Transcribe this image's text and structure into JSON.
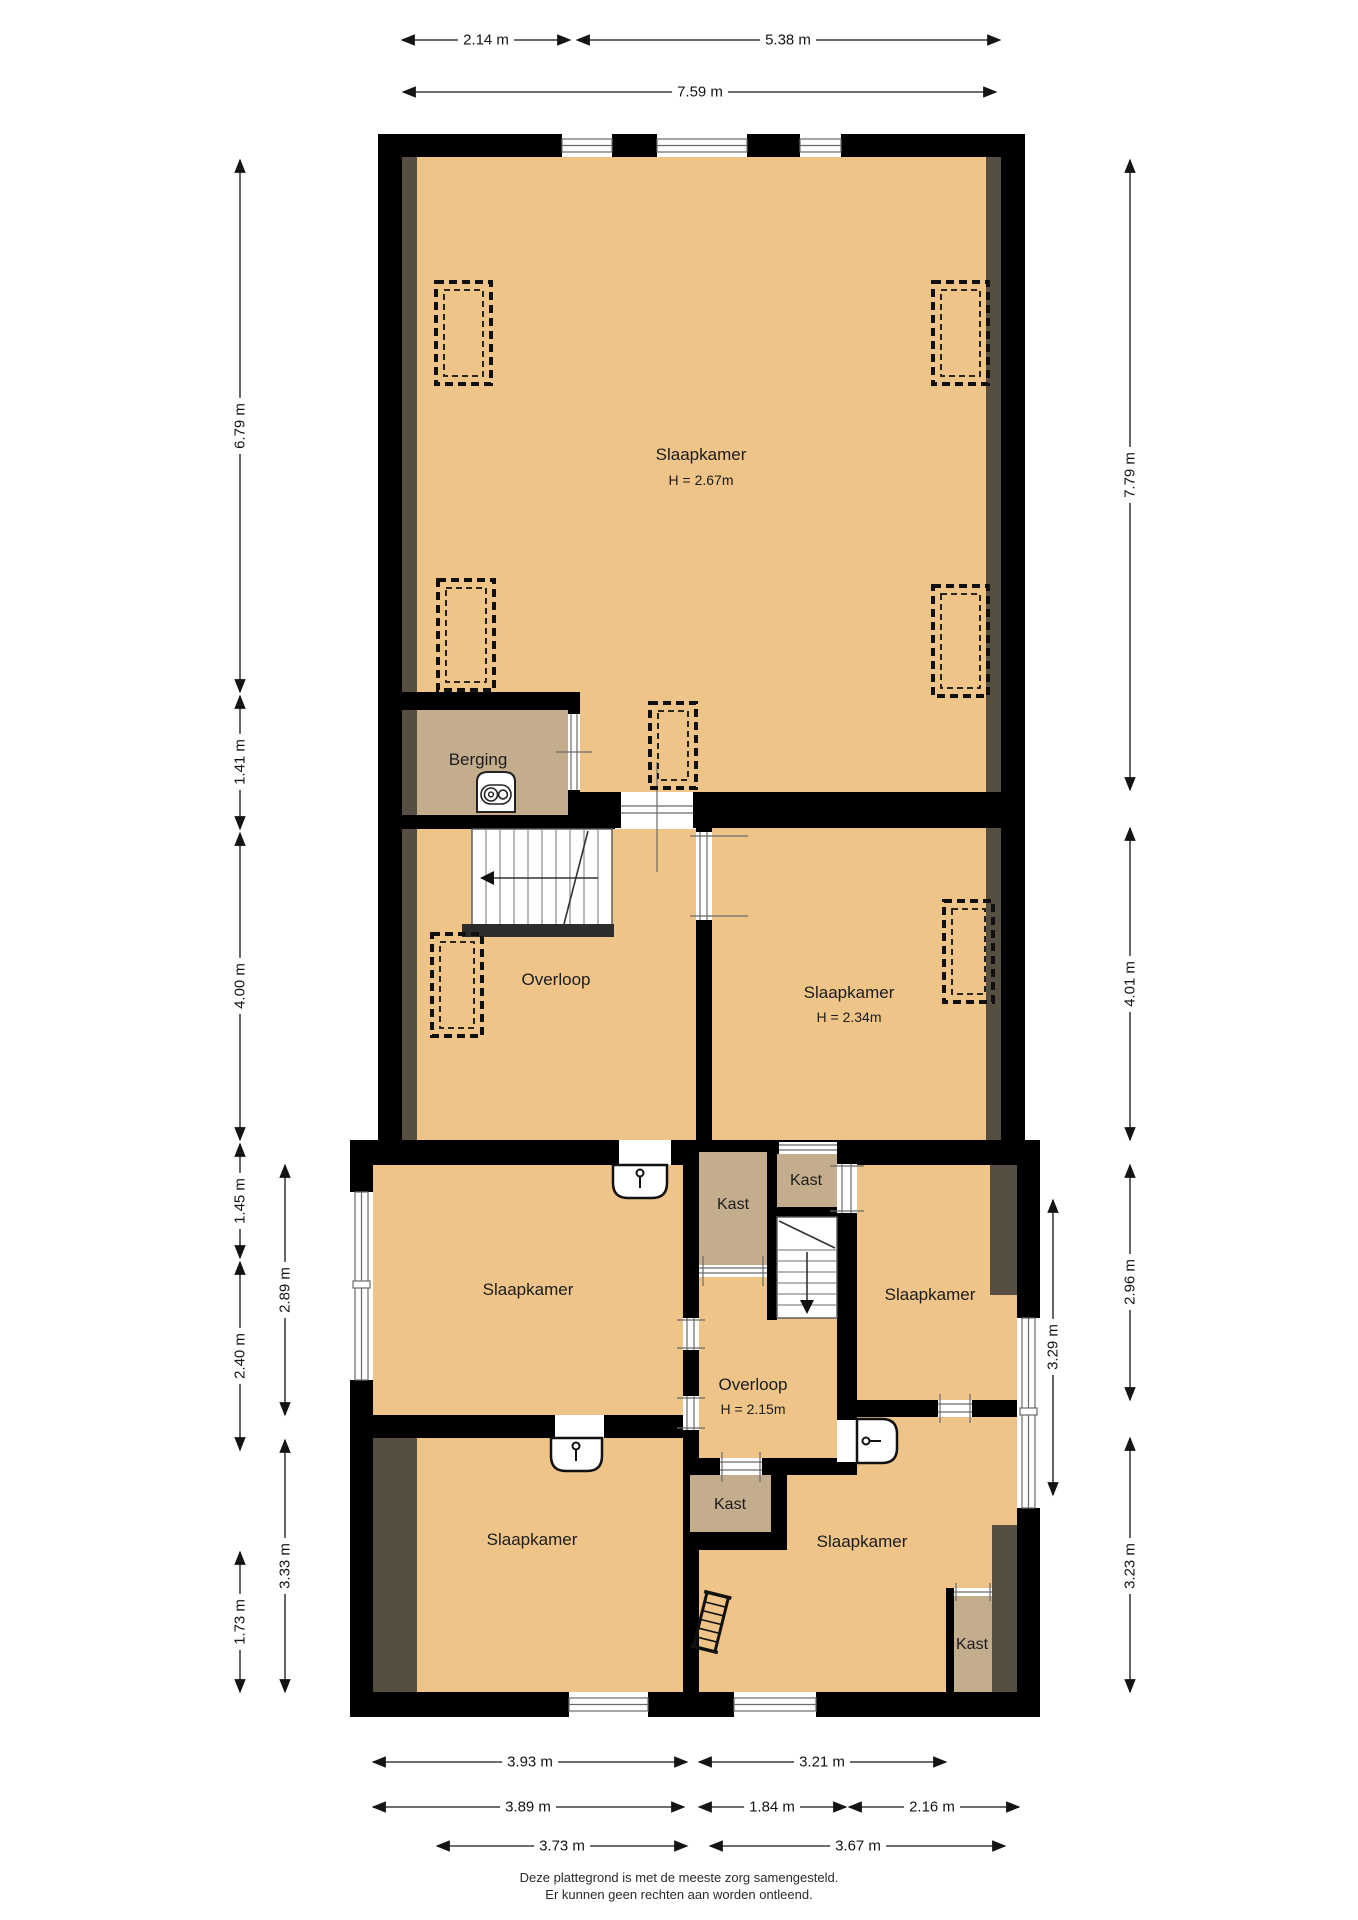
{
  "floorplan": {
    "rooms": {
      "slaapkamer_top": {
        "label": "Slaapkamer",
        "height": "H = 2.67m"
      },
      "berging": {
        "label": "Berging"
      },
      "overloop_mid": {
        "label": "Overloop"
      },
      "slaapkamer_right_mid": {
        "label": "Slaapkamer",
        "height": "H = 2.34m"
      },
      "slaapkamer_upper_left": {
        "label": "Slaapkamer"
      },
      "kast_middle": {
        "label": "Kast"
      },
      "kast_top_right": {
        "label": "Kast"
      },
      "overloop_lower": {
        "label": "Overloop",
        "height": "H = 2.15m"
      },
      "slaapkamer_right": {
        "label": "Slaapkamer"
      },
      "slaapkamer_lower_left": {
        "label": "Slaapkamer"
      },
      "kast_lower_middle": {
        "label": "Kast"
      },
      "slaapkamer_lower_right": {
        "label": "Slaapkamer"
      },
      "kast_lower_right": {
        "label": "Kast"
      }
    },
    "dimensions": {
      "top": [
        "2.14 m",
        "5.38 m",
        "7.59 m"
      ],
      "left_outer": [
        "6.79 m",
        "1.41 m",
        "4.00 m",
        "1.45 m",
        "2.40 m",
        "1.73 m"
      ],
      "left_inner": [
        "2.89 m",
        "3.33 m"
      ],
      "right_outer": [
        "7.79 m",
        "4.01 m",
        "2.96 m",
        "3.23 m"
      ],
      "right_inner": [
        "3.29 m"
      ],
      "bottom_row1": [
        "3.93 m",
        "3.21 m"
      ],
      "bottom_row2": [
        "3.89 m",
        "1.84 m",
        "2.16 m"
      ],
      "bottom_row3": [
        "3.73 m",
        "3.67 m"
      ]
    },
    "icons": {
      "stairs_up": "stairs-up",
      "stairs_down": "stairs-down",
      "loft_ladder": "loft-ladder",
      "boiler": "boiler",
      "door": "door-with-key",
      "roof_window": "roof-window-dashed-marker",
      "window": "window"
    },
    "colors": {
      "floor": "#eec489",
      "closet": "#c4ad8d",
      "slope_strip": "#564e40",
      "wall": "#000000",
      "stairs": "#ffffff",
      "dim_text": "#141414"
    }
  },
  "footer": {
    "line1": "Deze plattegrond is met de meeste zorg samengesteld.",
    "line2": "Er kunnen geen rechten aan worden ontleend."
  }
}
